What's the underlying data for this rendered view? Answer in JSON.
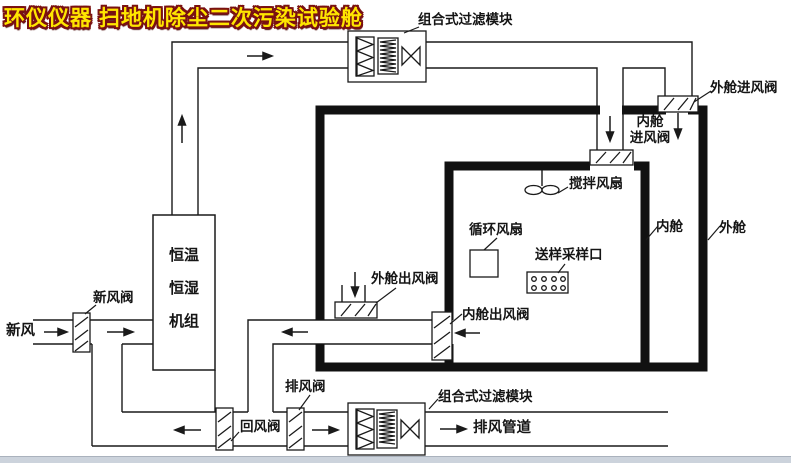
{
  "title": {
    "text": "环仪仪器 扫地机除尘二次污染试验舱",
    "fill_color": "#ffe600",
    "outline_color": "#7a1111"
  },
  "labels": {
    "filter_top": "组合式过滤模块",
    "filter_bottom": "组合式过滤模块",
    "outer_inlet_valve": "外舱进风阀",
    "inner_inlet_valve": "内舱\n进风阀",
    "stir_fan": "搅拌风扇",
    "circ_fan": "循环风扇",
    "sample_port": "送样采样口",
    "inner_chamber": "内舱",
    "outer_chamber": "外舱",
    "ahu": "恒温\n恒湿\n机组",
    "fresh_air_valve": "新风阀",
    "fresh_air": "新风",
    "outer_outlet_valve": "外舱出风阀",
    "inner_outlet_valve": "内舱出风阀",
    "exhaust_valve": "排风阀",
    "return_valve": "回风阀",
    "exhaust_duct": "排风管道"
  },
  "colors": {
    "line": "#1a1a1a",
    "wall": "#111111",
    "background": "#ffffff"
  }
}
